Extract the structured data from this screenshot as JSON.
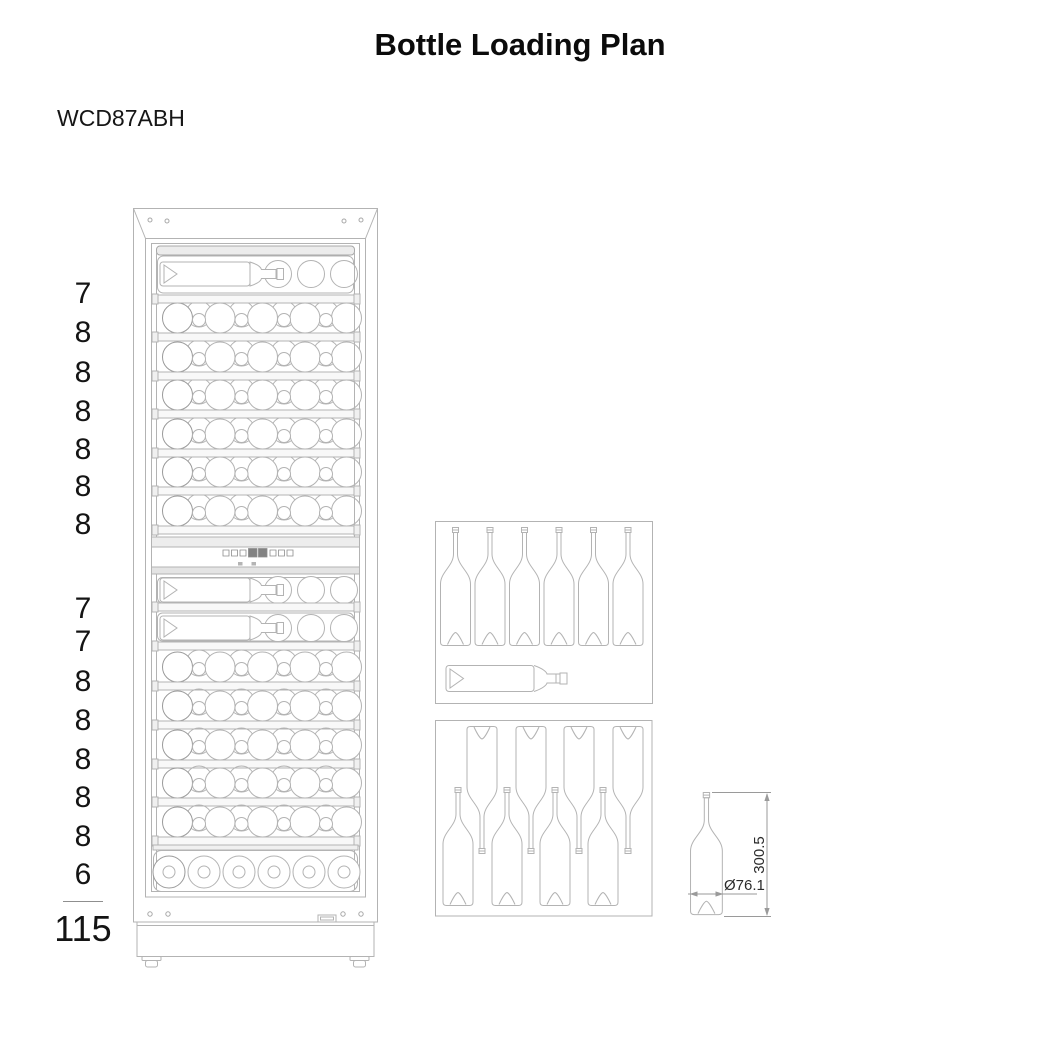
{
  "page": {
    "title": "Bottle Loading Plan",
    "model": "WCD87ABH"
  },
  "loading": {
    "upper_zone_counts": [
      "7",
      "8",
      "8",
      "8",
      "8",
      "8",
      "8"
    ],
    "lower_zone_counts": [
      "7",
      "7",
      "8",
      "8",
      "8",
      "8",
      "8",
      "6"
    ],
    "total": "115"
  },
  "bottle_dimensions": {
    "height": "300.5",
    "diameter": "Ø76.1"
  },
  "diagrams": {
    "cabinet": "wine-cabinet-front-view",
    "standing_bottles": "six-standing-bottles-and-one-lying-bottle",
    "alternating_bottles": "eight-alternating-lying-bottles",
    "dimension_drawing": "single-bottle-with-dimensions"
  },
  "colors": {
    "line": "#b3b3b3",
    "line_dark": "#989898",
    "panel_fill": "#ececec",
    "display_fill": "#828282",
    "text": "#111111"
  }
}
